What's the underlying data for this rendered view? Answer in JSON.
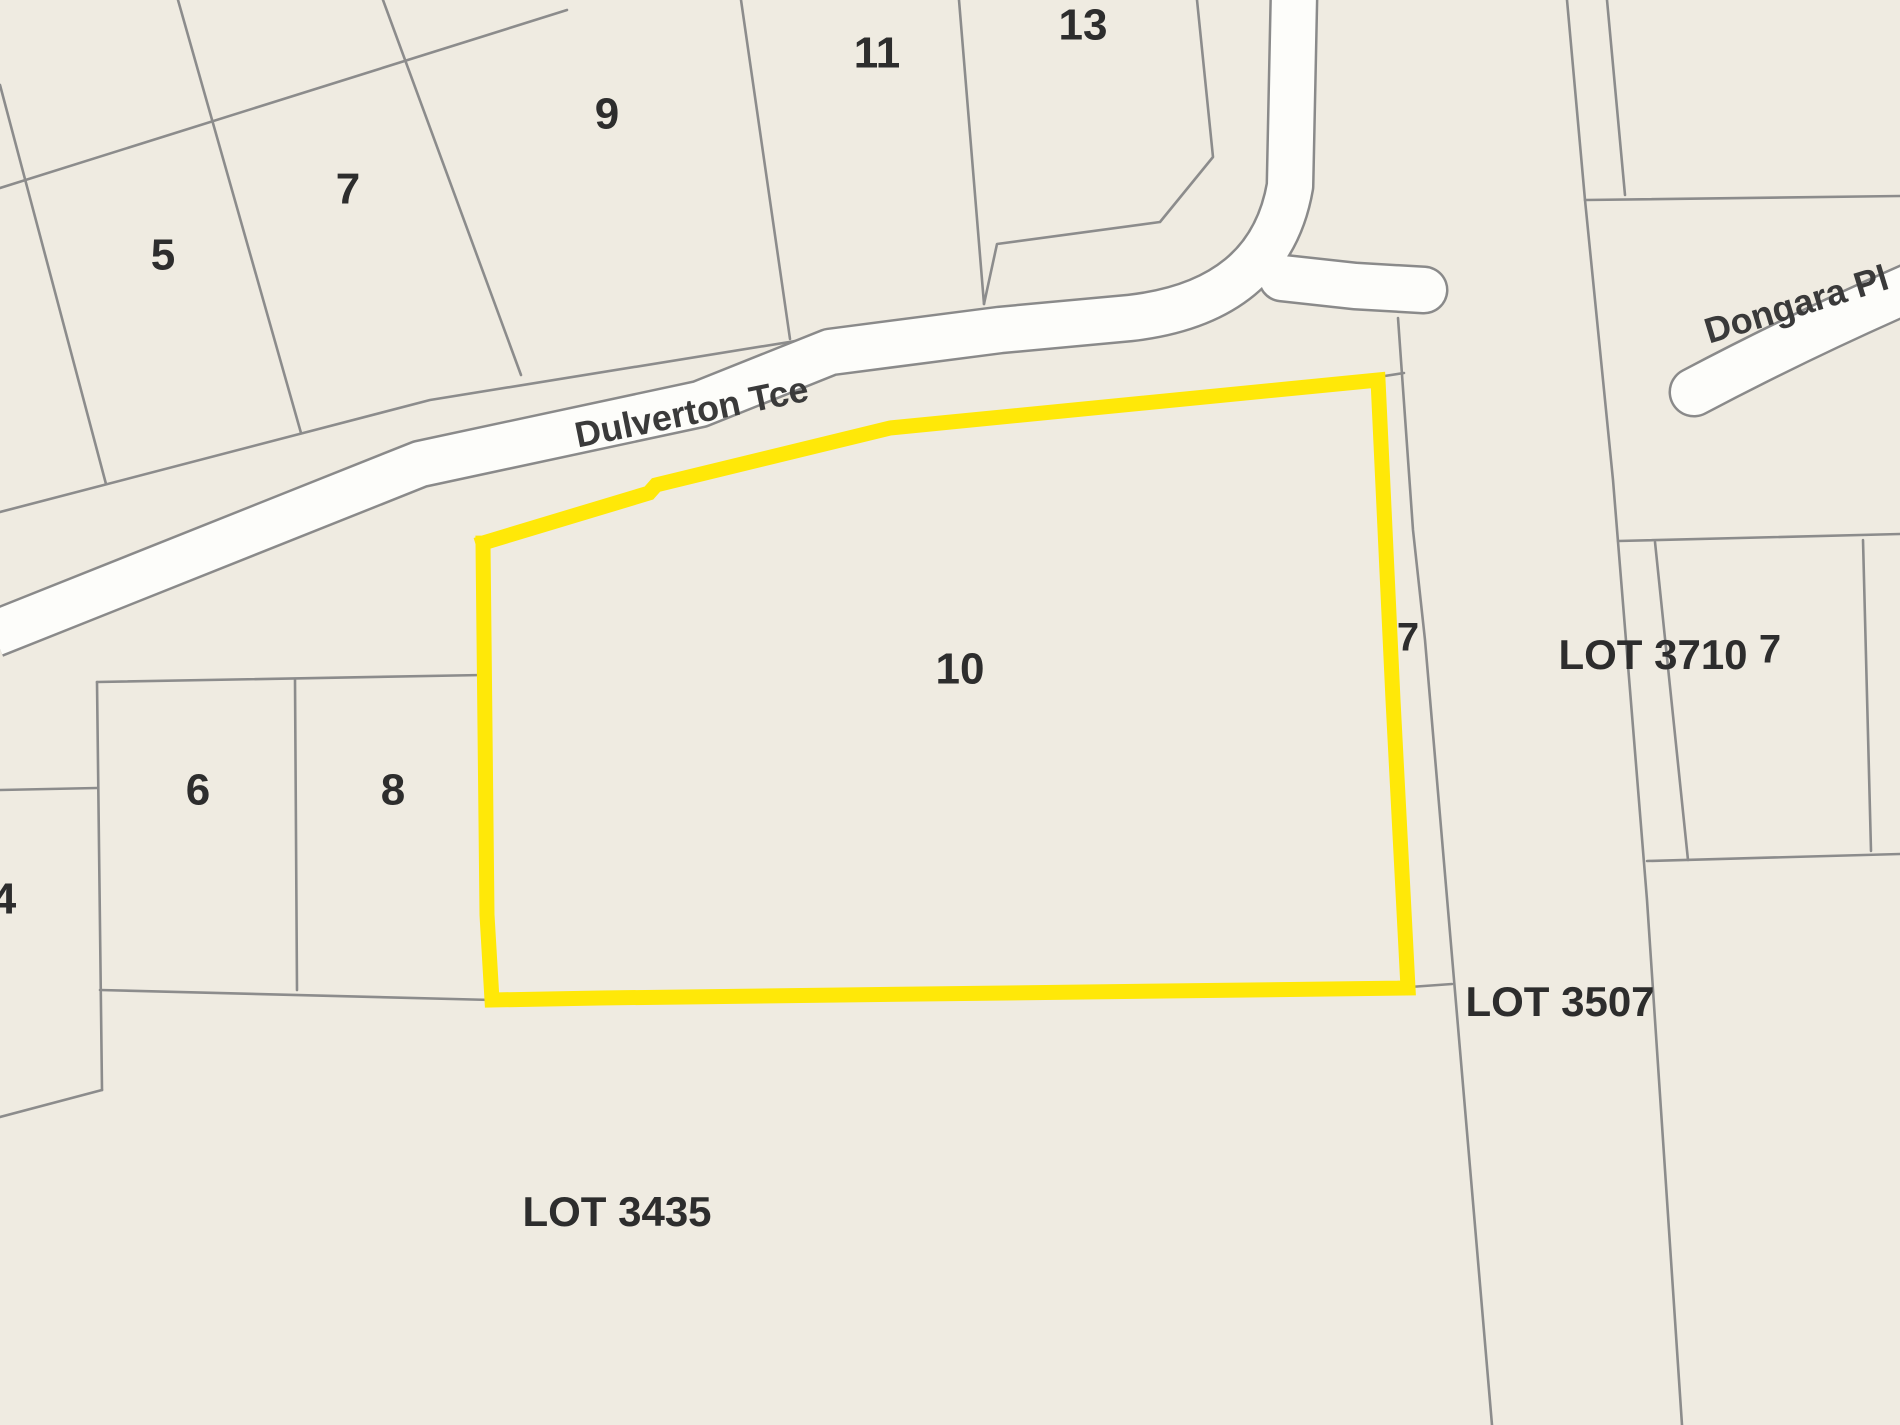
{
  "title": "Cadastral lot map with highlighted Lot 10",
  "colors": {
    "background": "#efebe1",
    "parcel_line": "#8c8c8c",
    "road_fill": "#fdfdfa",
    "road_casing": "#8a8a8a",
    "highlight": "#ffe808",
    "lot_label": "#2d2d2d",
    "street_label": "#3a3a3a"
  },
  "map": {
    "width": 1900,
    "height": 1425,
    "parcel_line_width": 2.6,
    "roads": [
      {
        "name": "dulverton-tce-main",
        "d": "M -6 634 L 420 464 L 700 404 L 830 352 L 1000 330 L 1130 318 Q 1270 302 1290 186 L 1294 -6",
        "width": 44,
        "cap": "butt"
      },
      {
        "name": "dulverton-east-stub",
        "d": "M 1282 278 L 1355 286 L 1424 290",
        "width": 44,
        "cap": "round"
      },
      {
        "name": "dongara-pl",
        "d": "M 1694 392 Q 1800 336 1912 287",
        "width": 46,
        "cap": "round"
      }
    ],
    "parcel_lines": [
      {
        "name": "rear-diagonal-northwest",
        "points": "0,188 567,10"
      },
      {
        "name": "lot5-west-boundary",
        "points": "0,85 106,484"
      },
      {
        "name": "lot5-lot7-boundary",
        "points": "178,0 301,433"
      },
      {
        "name": "lot7-lot9-boundary",
        "points": "383,0 521,375"
      },
      {
        "name": "lot9-lot11-boundary",
        "points": "741,0 790,339"
      },
      {
        "name": "lot11-lot13-boundary",
        "points": "959,0 984,304"
      },
      {
        "name": "lot13-east-boundary",
        "points": "1197,0 1213,157 1160,222 997,244 984,304"
      },
      {
        "name": "lots-frontage-line",
        "points": "0,512 430,400 975,312"
      },
      {
        "name": "road-reserve-east-line",
        "points": "1398,318 1413,530 1425,640 1460,1050 1492,1425"
      },
      {
        "name": "stub-line-top",
        "points": "1378,377 1404,373"
      },
      {
        "name": "stub-line-bottom",
        "points": "1410,987 1452,984"
      },
      {
        "name": "reserve-far-east-line",
        "points": "1567,0 1585,200 1613,480 1647,900 1682,1425"
      },
      {
        "name": "narrow-strip-east-line",
        "points": "1607,0 1625,195"
      },
      {
        "name": "northeast-horizontal-boundary",
        "points": "1585,200 1900,196"
      },
      {
        "name": "lot3710-block-top",
        "points": "1618,541 1900,534"
      },
      {
        "name": "lot3710-west-boundary",
        "points": "1655,542 1688,860"
      },
      {
        "name": "lot3710-east-boundary",
        "points": "1863,540 1871,851"
      },
      {
        "name": "lot3710-block-bottom",
        "points": "1647,861 1900,854"
      },
      {
        "name": "lot6-8-block-top",
        "points": "97,682 483,675"
      },
      {
        "name": "lot6-8-block-west",
        "points": "97,682 102,1090"
      },
      {
        "name": "lot6-lot8-divider",
        "points": "295,680 297,990"
      },
      {
        "name": "lot6-8-block-bottom",
        "points": "100,990 492,1000"
      },
      {
        "name": "lot4-top-boundary",
        "points": "0,790 97,788"
      },
      {
        "name": "lot4-bottom-boundary",
        "points": "0,1117 102,1090"
      }
    ],
    "highlight_parcel": {
      "lot": "10",
      "stroke_width": 15,
      "points": "483,543 649,493 656,485 890,428 1378,380 1393,700 1408,988 600,998 492,1000 487,915 483,543"
    },
    "street_labels": [
      {
        "name": "street-label-dulverton-tce",
        "text": "Dulverton Tce",
        "x": 694,
        "y": 424,
        "size": 36,
        "rot": -11.5
      },
      {
        "name": "street-label-dongara-pl",
        "text": "Dongara Pl",
        "x": 1800,
        "y": 316,
        "size": 36,
        "rot": -17
      }
    ],
    "labels": [
      {
        "name": "lot-label-5",
        "text": "5",
        "x": 163,
        "y": 258,
        "size": 44,
        "rot": 0
      },
      {
        "name": "lot-label-7-north",
        "text": "7",
        "x": 348,
        "y": 192,
        "size": 44,
        "rot": 0
      },
      {
        "name": "lot-label-9",
        "text": "9",
        "x": 607,
        "y": 117,
        "size": 44,
        "rot": 0
      },
      {
        "name": "lot-label-11",
        "text": "11",
        "x": 877,
        "y": 56,
        "size": 44,
        "rot": 0
      },
      {
        "name": "lot-label-13",
        "text": "13",
        "x": 1083,
        "y": 28,
        "size": 44,
        "rot": 0
      },
      {
        "name": "lot-label-6",
        "text": "6",
        "x": 198,
        "y": 793,
        "size": 44,
        "rot": 0
      },
      {
        "name": "lot-label-8",
        "text": "8",
        "x": 393,
        "y": 793,
        "size": 44,
        "rot": 0
      },
      {
        "name": "lot-label-4",
        "text": "4",
        "x": 4,
        "y": 902,
        "size": 44,
        "rot": 0
      },
      {
        "name": "lot-label-10-highlighted",
        "text": "10",
        "x": 960,
        "y": 672,
        "size": 44,
        "rot": 0
      },
      {
        "name": "lot-label-7-east",
        "text": "7",
        "x": 1408,
        "y": 640,
        "size": 40,
        "rot": 0
      },
      {
        "name": "lot-label-3710",
        "text": "LOT 3710",
        "x": 1653,
        "y": 658,
        "size": 42,
        "rot": 0
      },
      {
        "name": "lot-label-3710-7",
        "text": "7",
        "x": 1770,
        "y": 652,
        "size": 40,
        "rot": 0
      },
      {
        "name": "lot-label-3507",
        "text": "LOT 3507",
        "x": 1560,
        "y": 1005,
        "size": 42,
        "rot": 0
      },
      {
        "name": "lot-label-3435",
        "text": "LOT 3435",
        "x": 617,
        "y": 1215,
        "size": 42,
        "rot": 0
      }
    ]
  }
}
